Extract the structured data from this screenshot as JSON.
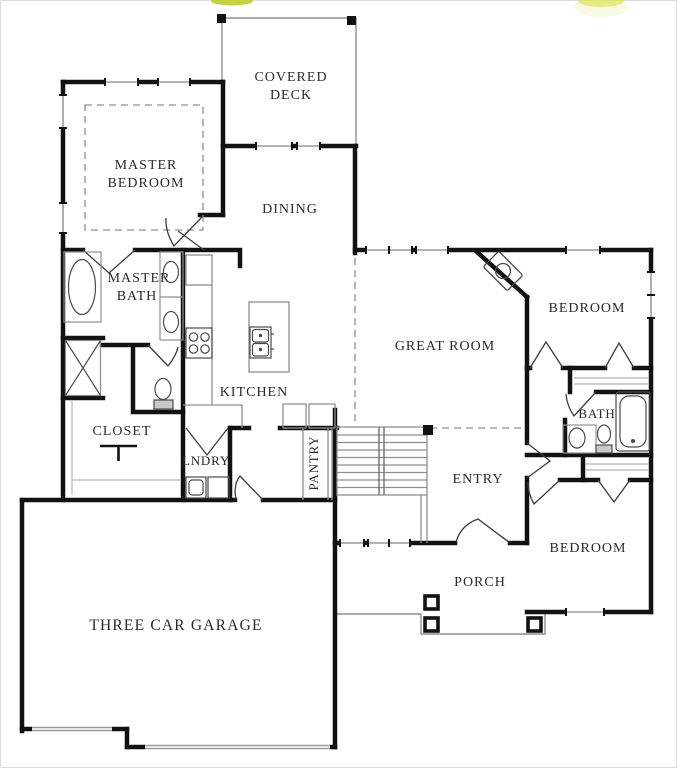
{
  "document": {
    "type": "floor-plan"
  },
  "palette": {
    "wall": "#121212",
    "thin_line": "#8f8f8f",
    "window_line": "#9a9a9a",
    "fixture_line": "#4a4a4a",
    "dashed_line": "#8f8f8f",
    "label": "#2a2a2a",
    "watermark_yellow": "#ccd42f",
    "frame": "#dcdcdc"
  },
  "rooms": [
    {
      "id": "covered-deck",
      "lines": [
        "COVERED",
        "DECK"
      ]
    },
    {
      "id": "master-bedroom",
      "lines": [
        "MASTER",
        "BEDROOM"
      ]
    },
    {
      "id": "dining",
      "lines": [
        "DINING"
      ]
    },
    {
      "id": "master-bath",
      "lines": [
        "MASTER",
        "BATH"
      ]
    },
    {
      "id": "kitchen",
      "lines": [
        "KITCHEN"
      ]
    },
    {
      "id": "great-room",
      "lines": [
        "GREAT ROOM"
      ]
    },
    {
      "id": "bedroom-upper",
      "lines": [
        "BEDROOM"
      ]
    },
    {
      "id": "bath",
      "lines": [
        "BATH"
      ]
    },
    {
      "id": "closet",
      "lines": [
        "CLOSET"
      ]
    },
    {
      "id": "laundry",
      "lines": [
        "LNDRY"
      ]
    },
    {
      "id": "pantry",
      "lines": [
        "PANTRY"
      ]
    },
    {
      "id": "entry",
      "lines": [
        "ENTRY"
      ]
    },
    {
      "id": "bedroom-lower",
      "lines": [
        "BEDROOM"
      ]
    },
    {
      "id": "porch",
      "lines": [
        "PORCH"
      ]
    },
    {
      "id": "garage",
      "lines": [
        "THREE CAR GARAGE"
      ]
    }
  ],
  "fixtures": [
    "garden-tub",
    "shower",
    "toilet",
    "double-vanity-sinks",
    "closet-rod",
    "refrigerator",
    "cooktop",
    "island-double-sink",
    "washer",
    "dryer",
    "pantry-shelves",
    "basement-stairs",
    "corner-fireplace",
    "bathtub",
    "vanity-sink",
    "linen-shelves",
    "porch-columns",
    "deck-posts"
  ]
}
